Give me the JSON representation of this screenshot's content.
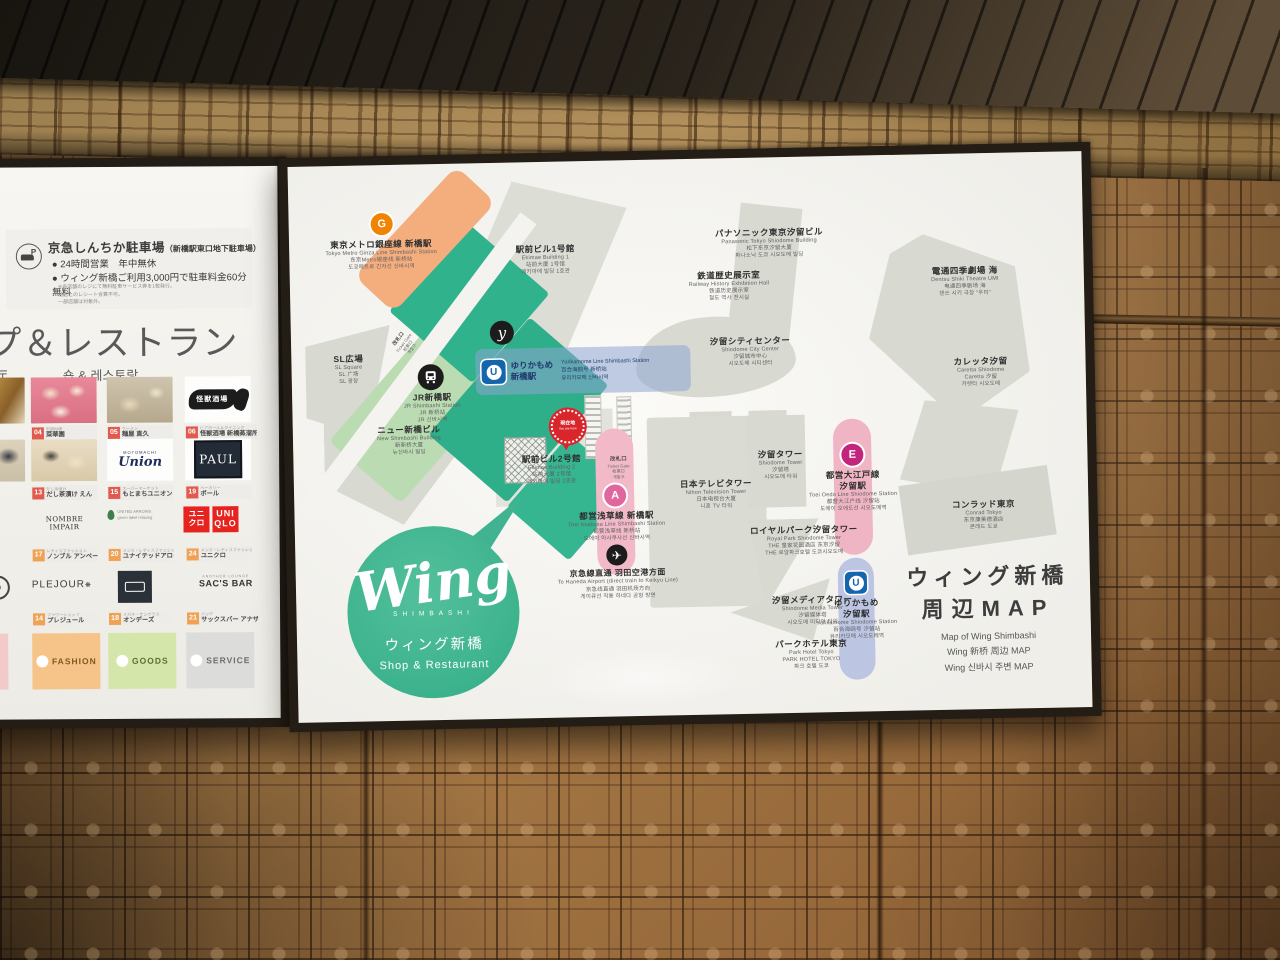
{
  "left_panel": {
    "parking": {
      "icon": "parking-car-icon",
      "title": "京急しんちか駐車場",
      "subtitle": "（新橋駅東口地下駐車場）",
      "bullet1": "● 24時間営業　年中無休",
      "bullet2": "● ウィング新橋ご利用3,000円で駐車料金60分無料",
      "note1": "※各店舗のレジにて無料駐車サービス券を1枚発行。",
      "note2": "他店とのレシート合算不可。",
      "note3": "一部店舗は対象外。"
    },
    "heading_ja": "プ＆レストラン",
    "heading_zh": "厅",
    "heading_ko": "숍 & 레스토랑",
    "partial_row3": "E",
    "partial_row4": "D",
    "shops": [
      {
        "num": "04",
        "cat": "中国料理",
        "name": "菜華園"
      },
      {
        "num": "05",
        "cat": "ラーメン",
        "name": "麺屋 直久"
      },
      {
        "num": "06",
        "cat": "ビアホール＆ダイニング",
        "name": "怪獣酒場 新橋蒸溜所"
      },
      {
        "num": "13",
        "cat": "だし茶漬け",
        "name": "だし茶漬け えん"
      },
      {
        "num": "15",
        "cat": "スーパーマーケット",
        "name": "もとまちユニオン"
      },
      {
        "num": "19",
        "cat": "ベーカリー",
        "name": "ポール"
      },
      {
        "num": "17",
        "cat": "レディスファッション",
        "name": "ノンブル アンペール"
      },
      {
        "num": "20",
        "cat": "メンズ・レディスファッション",
        "name": "ユナイテッドアローズGLR"
      },
      {
        "num": "24",
        "cat": "メンズ・レディスファッション",
        "name": "ユニクロ"
      },
      {
        "num": "14",
        "cat": "フラワーショップ",
        "name": "プレジュール"
      },
      {
        "num": "18",
        "cat": "メガネ・サングラス",
        "name": "オンデーズ"
      },
      {
        "num": "21",
        "cat": "バッグ",
        "name": "サックスバー アナザーラウンジ"
      }
    ],
    "logos": {
      "kaiju": "怪獣酒場",
      "union": "Union",
      "union_small": "MOTOMACHI",
      "paul": "PAUL",
      "nombre": "NOMBRE IMPAIR",
      "glr1": "UNITED ARROWS",
      "glr2": "green label relaxing",
      "uniqlo_jp1": "ユニ",
      "uniqlo_jp2": "クロ",
      "uniqlo_en1": "UNI",
      "uniqlo_en2": "QLO",
      "plejour": "PLEJOUR",
      "sacsbar": "SAC'S BAR",
      "sacsbar_small": "ANOTHER LOUNGE"
    },
    "categories": [
      {
        "label": "FASHION"
      },
      {
        "label": "GOODS"
      },
      {
        "label": "SERVICE"
      }
    ]
  },
  "map": {
    "title_ja1": "ウィング新橋",
    "title_ja2": "周辺MAP",
    "title_en": "Map of Wing Shimbashi",
    "title_zh": "Wing 新桥 周边 MAP",
    "title_ko": "Wing 신바시 주변 MAP",
    "logo": {
      "name": "Wing",
      "sub": "SHIMBASHI",
      "ja": "ウィング新橋",
      "tag": "Shop & Restaurant"
    },
    "buildings": [
      {
        "ja": "SL広場",
        "en": "SL Square",
        "zh": "SL 广场",
        "ko": "SL 광장"
      },
      {
        "ja": "JR新橋駅",
        "en": "JR Shimbashi Station",
        "zh": "JR 新桥站",
        "ko": "JR 신바시역"
      },
      {
        "ja": "ニュー新橋ビル",
        "en": "New Shimbashi Building",
        "zh": "新新桥大厦",
        "ko": "뉴신바시 빌딩"
      },
      {
        "ja": "駅前ビル1号館",
        "en": "Ekimae Building 1",
        "zh": "站前大厦 1号馆",
        "ko": "에키마에 빌딩 1호관"
      },
      {
        "ja": "駅前ビル2号館",
        "en": "Ekimae Building 2",
        "zh": "站前大厦 2号馆",
        "ko": "에키마에 빌딩 2호관"
      },
      {
        "ja": "鉄道歴史展示室",
        "en": "Railway History Exhibition Hall",
        "zh": "铁道历史展示室",
        "ko": "철도 역사 전시실"
      },
      {
        "ja": "パナソニック東京汐留ビル",
        "en": "Panasonic Tokyo Shiodome Building",
        "zh": "松下东京汐留大厦",
        "ko": "파나소닉 도쿄 시오도메 빌딩"
      },
      {
        "ja": "汐留シティセンター",
        "en": "Shiodome City Center",
        "zh": "汐留城市中心",
        "ko": "시오도메 시티센터"
      },
      {
        "ja": "電通四季劇場 海",
        "en": "Dentsu Shiki Theatre UMI",
        "zh": "电通四季剧场 海",
        "ko": "덴쓰 시키 극장 \"우미\""
      },
      {
        "ja": "カレッタ汐留",
        "en": "Caretta Shiodome",
        "zh": "Caretta 汐留",
        "ko": "카렛타 시오도메"
      },
      {
        "ja": "コンラッド東京",
        "en": "Conrad Tokyo",
        "zh": "东京康莱德酒店",
        "ko": "콘래드 도쿄"
      },
      {
        "ja": "日本テレビタワー",
        "en": "Nihon Television Tower",
        "zh": "日本电视台大厦",
        "ko": "니혼 TV 타워"
      },
      {
        "ja": "汐留タワー",
        "en": "Shiodome Tower",
        "zh": "汐留塔",
        "ko": "시오도메 타워"
      },
      {
        "ja": "ロイヤルパーク汐留タワー",
        "en": "Royal Park Shiodome Tower",
        "zh": "THE 皇家花园酒店 东京汐留",
        "ko": "THE 로얄파크호텔 도쿄시오도메"
      },
      {
        "ja": "汐留メディアタワー",
        "en": "Shiodome Media Tower",
        "zh": "汐留媒体塔",
        "ko": "시오도메 미디어 타워"
      },
      {
        "ja": "パークホテル東京",
        "en": "Park Hotel Tokyo",
        "zh": "PARK HOTEL TOKYO",
        "ko": "파크 호텔 도쿄"
      }
    ],
    "stations": {
      "ginza": {
        "badge": "G",
        "ja": "東京メトロ銀座線 新橋駅",
        "en": "Tokyo Metro Ginza Line Shimbashi Station",
        "zh": "东京Metro银座线 新桥站",
        "ko": "도쿄메트로 긴자선 신바시역"
      },
      "yurikamome_shimbashi": {
        "badge": "U",
        "ja1": "ゆりかもめ",
        "ja2": "新橋駅",
        "en": "Yurikamome Line Shimbashi Station",
        "zh": "百合海鸥号 新桥站",
        "ko": "유리카모메 신바시역"
      },
      "asakusa": {
        "badge": "A",
        "ja": "都営浅草線 新橋駅",
        "en": "Toei Asakusa Line Shimbashi Station",
        "zh": "都营浅草线 新桥站",
        "ko": "도에이 아사쿠사선 신바시역"
      },
      "haneda": {
        "ja": "京急線直通 羽田空港方面",
        "en": "To Haneda Airport (direct train to Keikyu Line)",
        "zh": "京急线直通 羽田机场方向",
        "ko": "게이큐선 직통 하네다 공항 방면"
      },
      "oedo": {
        "badge": "E",
        "ja1": "都営大江戸線",
        "ja2": "汐留駅",
        "en": "Toei Oedo Line Shiodome Station",
        "zh": "都营大江户线 汐留站",
        "ko": "도에이 오에도선 시오도메역"
      },
      "yurikamome_shiodome": {
        "badge": "U",
        "ja1": "ゆりかもめ",
        "ja2": "汐留駅",
        "en": "Yurikamome Shiodome Station",
        "zh": "百合海鸥号 汐留站",
        "ko": "유리카모메 시오도메역"
      }
    },
    "marks": {
      "you_are_here_ja": "現在地",
      "you_are_here_en": "You are here",
      "ticket_gate": {
        "ja": "改札口",
        "en": "Ticket Gate",
        "zh": "检票口",
        "ko": "개찰구"
      }
    },
    "colors": {
      "wing_green": "#3bb28c",
      "ginza_orange": "#f4ae7e",
      "asakusa_pink": "#f2b9c8",
      "oedo_magenta": "#c3257d",
      "yurikamome_blue": "#1565ad"
    }
  }
}
